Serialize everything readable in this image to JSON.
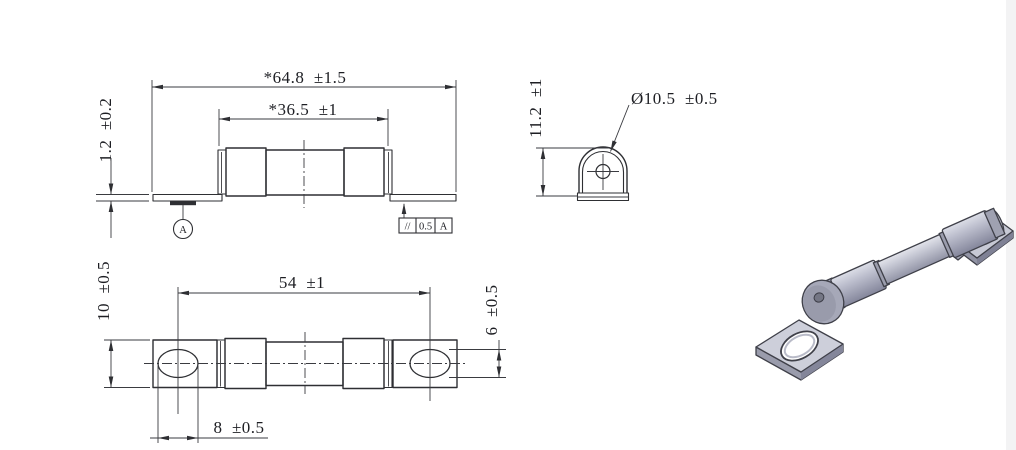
{
  "front_view": {
    "dim_overall_length": "*64.8  ±1.5",
    "dim_ceramic_body": "*36.5  ±1",
    "dim_terminal_thickness": "1.2  ±0.2",
    "datum_label": "A"
  },
  "side_view": {
    "dim_height": "11.2  ±1",
    "dim_cap_diameter": "Ø10.5  ±0.5"
  },
  "parallelism_frame": {
    "symbol": "//",
    "tolerance": "0.5",
    "datum_ref": "A"
  },
  "top_view": {
    "dim_hole_spacing": "54  ±1",
    "dim_terminal_width": "10  ±0.5",
    "dim_hole_minor": "6  ±0.5",
    "dim_hole_major": "8  ±0.5"
  },
  "colors": {
    "line": "#2e2f33",
    "background": "#ffffff",
    "render_body": "#b6b8c8",
    "render_cap_dark": "#84869b",
    "render_tab": "#cdcfda",
    "render_outline": "#3f4049"
  }
}
